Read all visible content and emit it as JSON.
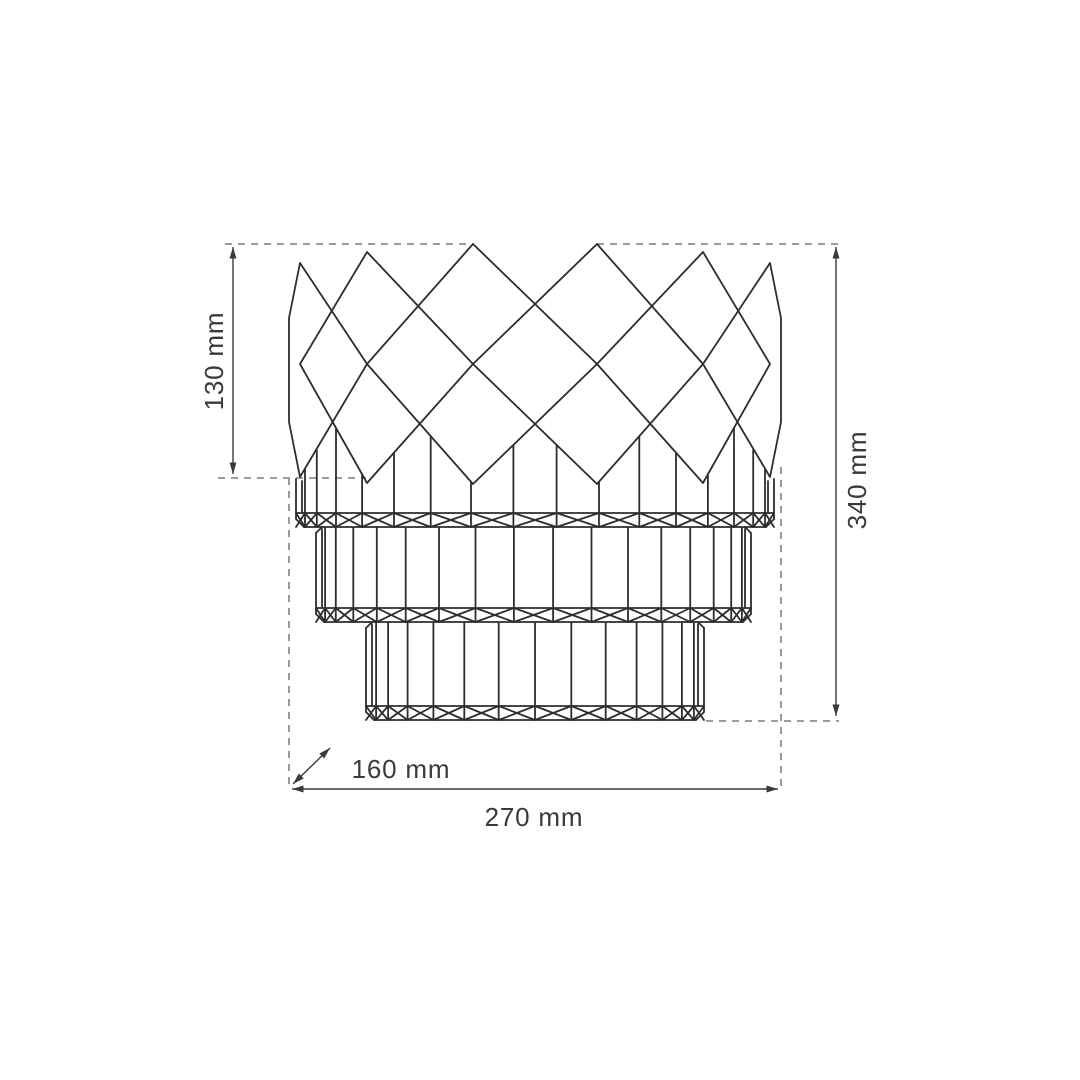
{
  "drawing": {
    "name": "crystal-wall-lamp-dimension-diagram",
    "labels": {
      "crown_height": "130 mm",
      "total_height": "340 mm",
      "depth": "160 mm",
      "width": "270 mm"
    },
    "colors": {
      "line": "#2d2d2d",
      "dimension": "#3a3a3a",
      "dashed": "#8f8f8f",
      "background": "#ffffff"
    }
  }
}
